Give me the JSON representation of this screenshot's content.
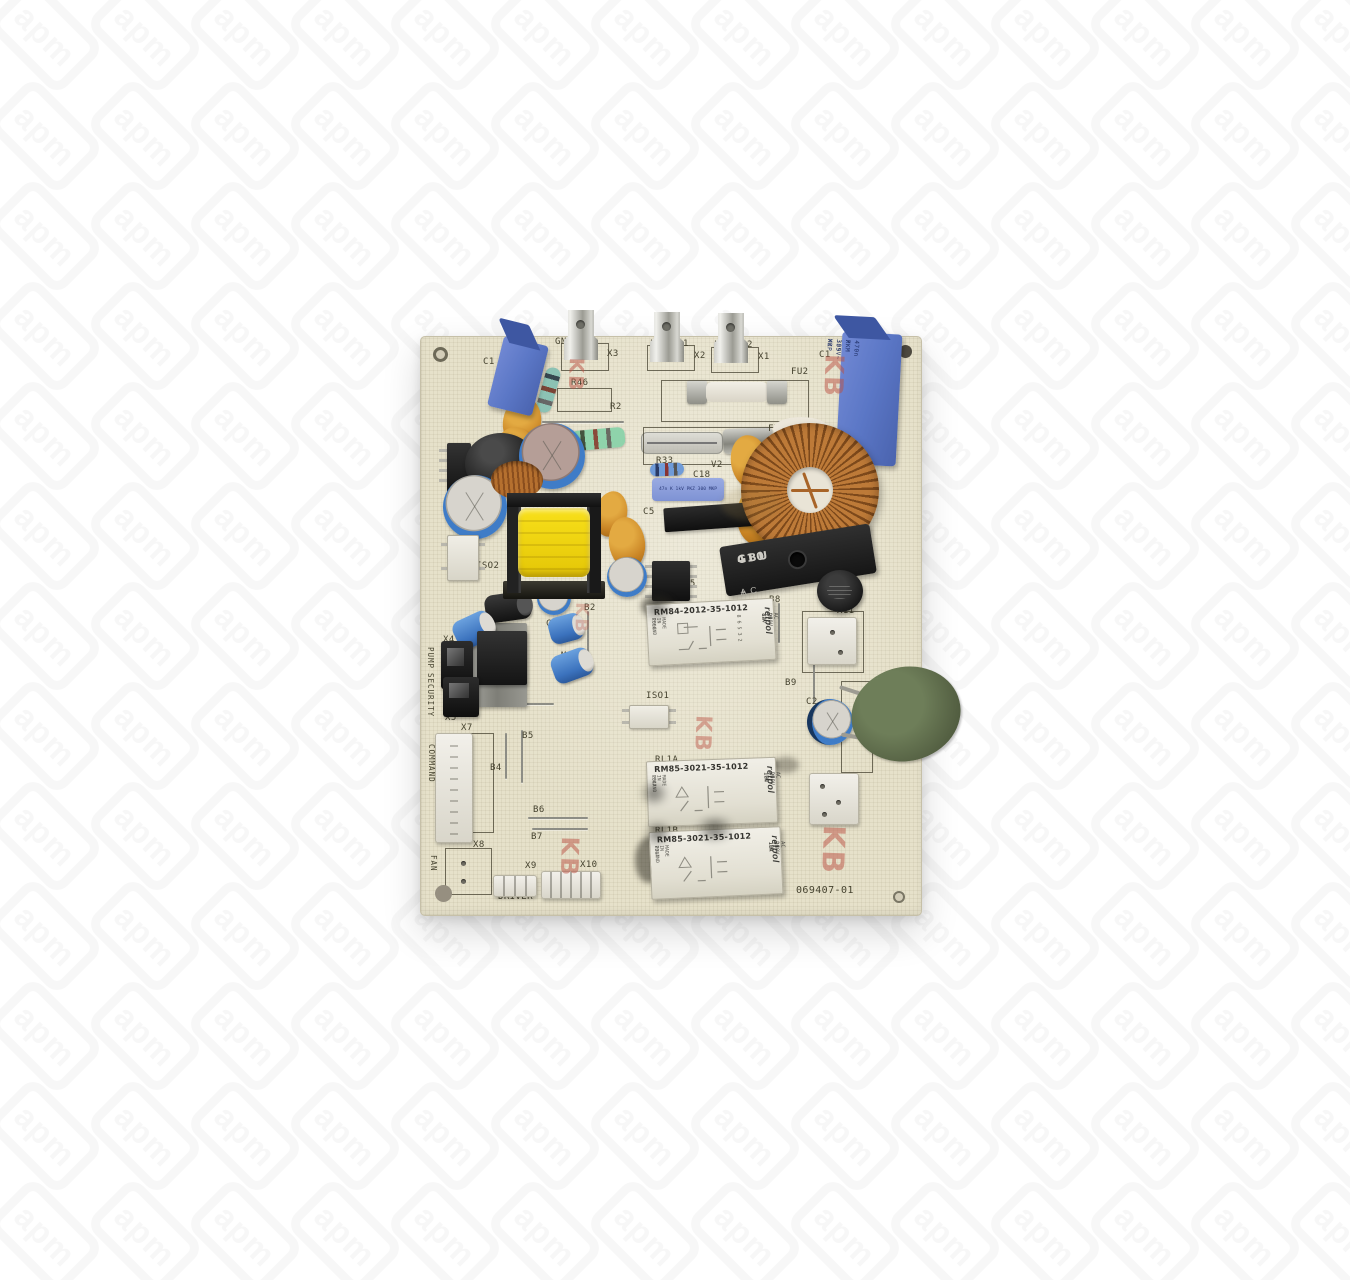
{
  "watermark": {
    "logo_text": "apm"
  },
  "board": {
    "stamp_text": "KB",
    "silkscreen_labels": [
      {
        "id": "c1_left",
        "text": "C1"
      },
      {
        "id": "r46",
        "text": "R46"
      },
      {
        "id": "r2",
        "text": "R2"
      },
      {
        "id": "v1",
        "text": "V1"
      },
      {
        "id": "r1",
        "text": "R1"
      },
      {
        "id": "gnd",
        "text": "GND"
      },
      {
        "id": "x3",
        "text": "X3"
      },
      {
        "id": "l1_l",
        "text": "L"
      },
      {
        "id": "l1_1",
        "text": "1"
      },
      {
        "id": "x2",
        "text": "X2"
      },
      {
        "id": "l2_l",
        "text": "L"
      },
      {
        "id": "l2_2",
        "text": "2"
      },
      {
        "id": "x1",
        "text": "X1"
      },
      {
        "id": "fu2",
        "text": "FU2"
      },
      {
        "id": "fu1",
        "text": "FU1"
      },
      {
        "id": "r33",
        "text": "R33"
      },
      {
        "id": "v2",
        "text": "V2"
      },
      {
        "id": "c18",
        "text": "C18"
      },
      {
        "id": "c5",
        "text": "C5"
      },
      {
        "id": "q3",
        "text": "Q3"
      },
      {
        "id": "c1_right",
        "text": "C1"
      },
      {
        "id": "u1",
        "text": "U1"
      },
      {
        "id": "iso2",
        "text": "ISO2"
      },
      {
        "id": "b2",
        "text": "B2"
      },
      {
        "id": "u5",
        "text": "U5"
      },
      {
        "id": "c7",
        "text": "C7"
      },
      {
        "id": "m6",
        "text": "M6"
      },
      {
        "id": "x4",
        "text": "X4"
      },
      {
        "id": "pump",
        "text": "PUMP"
      },
      {
        "id": "q6",
        "text": "Q6"
      },
      {
        "id": "x5",
        "text": "X5"
      },
      {
        "id": "security",
        "text": "SECURITY"
      },
      {
        "id": "b3",
        "text": "B3"
      },
      {
        "id": "b8",
        "text": "B8"
      },
      {
        "id": "fu3",
        "text": "FU3"
      },
      {
        "id": "x11",
        "text": "X11"
      },
      {
        "id": "b9",
        "text": "B9"
      },
      {
        "id": "iso1",
        "text": "ISO1"
      },
      {
        "id": "c2",
        "text": "C2"
      },
      {
        "id": "rt",
        "text": "RT"
      },
      {
        "id": "x6",
        "text": "X6"
      },
      {
        "id": "rl1a",
        "text": "RL1A"
      },
      {
        "id": "rl1b",
        "text": "RL1B"
      },
      {
        "id": "x7",
        "text": "X7"
      },
      {
        "id": "command",
        "text": "COMMAND"
      },
      {
        "id": "b5",
        "text": "B5"
      },
      {
        "id": "b4",
        "text": "B4"
      },
      {
        "id": "b6",
        "text": "B6"
      },
      {
        "id": "b7",
        "text": "B7"
      },
      {
        "id": "x8",
        "text": "X8"
      },
      {
        "id": "fan",
        "text": "FAN"
      },
      {
        "id": "x9",
        "text": "X9"
      },
      {
        "id": "driver",
        "text": "DRIVER"
      },
      {
        "id": "x10",
        "text": "X10"
      },
      {
        "id": "pn",
        "text": "069407-01"
      }
    ],
    "relays": {
      "rm84": {
        "model": "RM84-2012-35-1012",
        "brand": "relpol",
        "coil": "DC 12V",
        "contact": "AC 250V 8A",
        "origin": "MADE IN POLAND",
        "date_code": "2S9G",
        "pin_numbers": "8 6 5 3 2"
      },
      "rl1a": {
        "model": "RM85-3021-35-1012",
        "brand": "relpol",
        "coil": "DC 12V",
        "contact": "AC 250V 16A",
        "origin": "MADE IN POLAND",
        "date_code": "2347"
      },
      "rl1b": {
        "model": "RM85-3021-35-1012",
        "brand": "relpol",
        "coil": "DC 12V",
        "contact": "AC 250V 16A",
        "origin": "MADE IN POLAND",
        "date_code": "2347"
      }
    },
    "bridge_rectifier": {
      "series": "GBU",
      "value": "410",
      "plus": "+",
      "ac": "AC",
      "minus": "−"
    },
    "film_capacitor_right": {
      "line1": "470n X 305V~ X2",
      "line2": "PKM 339 MKP"
    },
    "capacitor_c18_text": "47n K 1kV PKZ 300 MKP"
  }
}
